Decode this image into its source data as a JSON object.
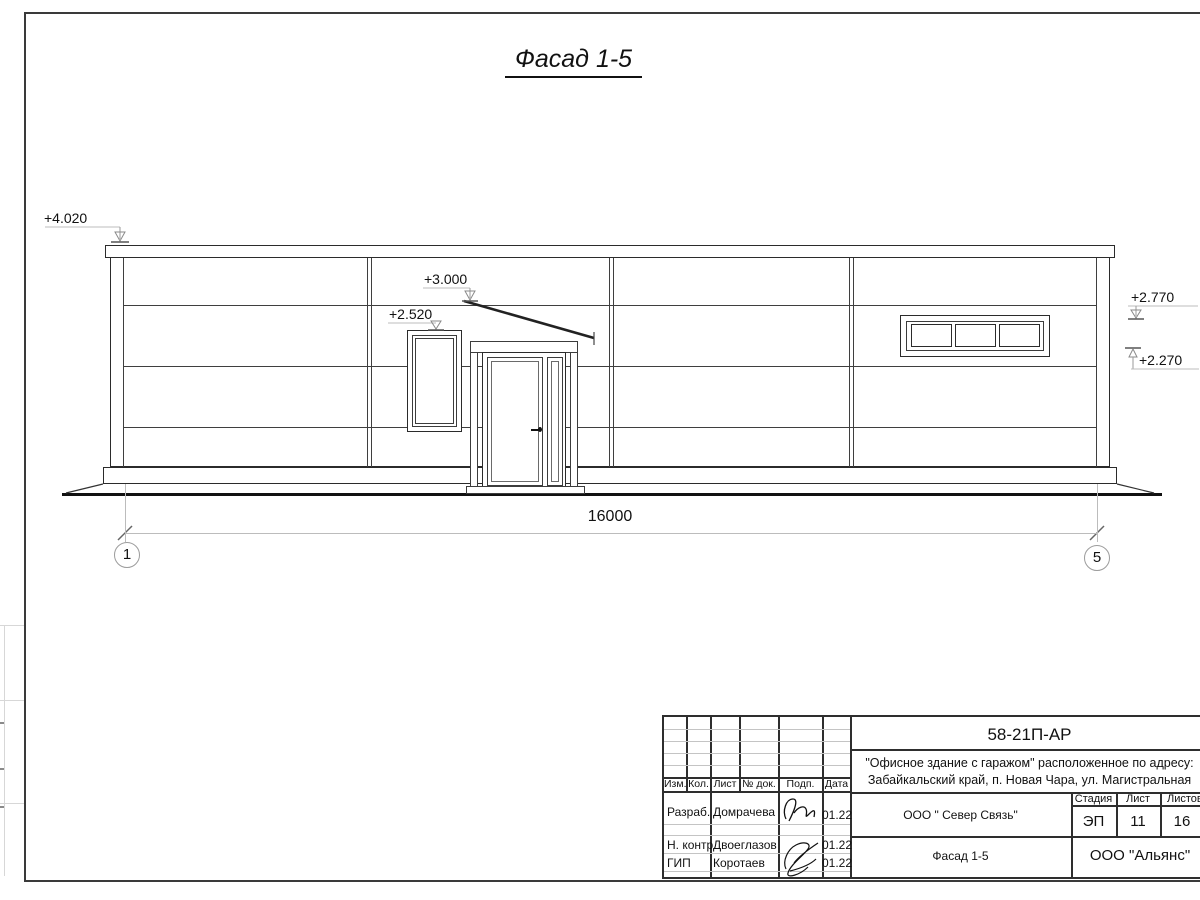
{
  "sheet": {
    "title": "Фасад 1-5"
  },
  "drawing": {
    "dim_total": "16000",
    "axis_start": "1",
    "axis_end": "5",
    "elev_parapet": "+4.020",
    "elev_canopy": "+3.000",
    "elev_window": "+2.520",
    "elev_ribbon_top": "+2.770",
    "elev_ribbon_bottom": "+2.270"
  },
  "title_block": {
    "doc_code": "58-21П-АР",
    "project_line1": "\"Офисное здание с гаражом\" расположенное по адресу:",
    "project_line2": "Забайкальский край, п. Новая Чара, ул. Магистральная",
    "client": "ООО \" Север Связь\"",
    "sheet_name": "Фасад 1-5",
    "company": "ООО \"Альянс\"",
    "stage_label": "Стадия",
    "stage": "ЭП",
    "sheet_label": "Лист",
    "sheet_no": "11",
    "sheets_label": "Листов",
    "sheets_total": "16",
    "columns": [
      "Изм.",
      "Кол.",
      "Лист",
      "№ док.",
      "Подп.",
      "Дата"
    ],
    "rows": [
      {
        "role": "Разраб.",
        "name": "Домрачева",
        "date": "01.22"
      },
      {
        "role": "Н. контр.",
        "name": "Двоеглазов",
        "date": "01.22"
      },
      {
        "role": "ГИП",
        "name": "Коротаев",
        "date": "01.22"
      }
    ]
  }
}
